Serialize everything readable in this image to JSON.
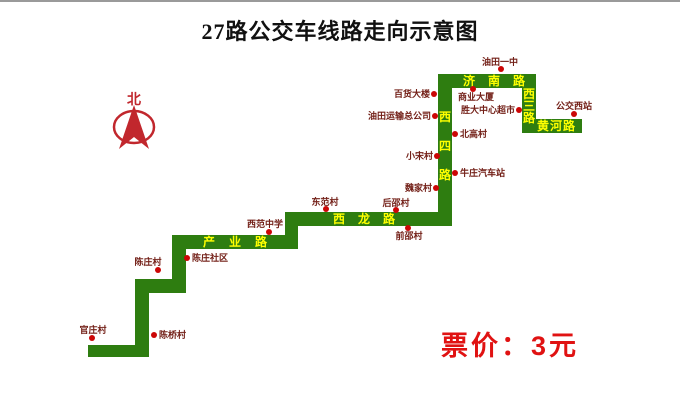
{
  "title": "27路公交车线路走向示意图",
  "compass": {
    "label": "北"
  },
  "fare": {
    "text": "票价：3元"
  },
  "colors": {
    "road_green": "#2e7d10",
    "road_label_yellow": "#ffff00",
    "stop_dot_red": "#cc0606",
    "stop_label_maroon": "#732018",
    "fare_red": "#e01212",
    "compass_red": "#c1272d",
    "title_black": "#111111"
  },
  "route": {
    "segments": [
      {
        "name": "bottom-west-segment",
        "x": 88,
        "y": 343,
        "w": 61,
        "h": 12
      },
      {
        "name": "vertical-1",
        "x": 135,
        "y": 287,
        "w": 14,
        "h": 68
      },
      {
        "name": "step-1",
        "x": 135,
        "y": 277,
        "w": 51,
        "h": 14
      },
      {
        "name": "vertical-2",
        "x": 172,
        "y": 233,
        "w": 14,
        "h": 58
      },
      {
        "name": "chanye-road",
        "x": 172,
        "y": 233,
        "w": 126,
        "h": 14
      },
      {
        "name": "vertical-3",
        "x": 285,
        "y": 210,
        "w": 13,
        "h": 37
      },
      {
        "name": "xilong-road",
        "x": 285,
        "y": 210,
        "w": 167,
        "h": 14
      },
      {
        "name": "xisi-road",
        "x": 438,
        "y": 72,
        "w": 14,
        "h": 152
      },
      {
        "name": "jinan-road",
        "x": 438,
        "y": 72,
        "w": 98,
        "h": 14
      },
      {
        "name": "xisan-road",
        "x": 522,
        "y": 72,
        "w": 14,
        "h": 59
      },
      {
        "name": "huanghe-road",
        "x": 522,
        "y": 117,
        "w": 60,
        "h": 14
      }
    ],
    "road_labels": [
      {
        "text": "产业路",
        "orient": "h",
        "x": 203,
        "y": 234,
        "spacing": 14
      },
      {
        "text": "西龙路",
        "orient": "h",
        "x": 333,
        "y": 211,
        "spacing": 13
      },
      {
        "text": "济南路",
        "orient": "h",
        "x": 463,
        "y": 73,
        "spacing": 13
      },
      {
        "text": "黄河路",
        "orient": "h",
        "x": 537,
        "y": 118,
        "spacing": 1
      },
      {
        "text": "西四路",
        "orient": "v",
        "x": 439,
        "y": 109,
        "spacing": 17
      },
      {
        "text": "西三路",
        "orient": "v",
        "x": 523,
        "y": 86,
        "spacing": 0
      }
    ],
    "stops": [
      {
        "label": "官庄村",
        "dot_x": 92,
        "dot_y": 336,
        "lx": 93,
        "ly": 328,
        "anchor": "center"
      },
      {
        "label": "陈桥村",
        "dot_x": 154,
        "dot_y": 333,
        "lx": 159,
        "ly": 333,
        "anchor": "right"
      },
      {
        "label": "陈庄村",
        "dot_x": 158,
        "dot_y": 268,
        "lx": 148,
        "ly": 260,
        "anchor": "center"
      },
      {
        "label": "陈庄社区",
        "dot_x": 187,
        "dot_y": 256,
        "lx": 192,
        "ly": 256,
        "anchor": "right"
      },
      {
        "label": "西范中学",
        "dot_x": 269,
        "dot_y": 230,
        "lx": 265,
        "ly": 222,
        "anchor": "center"
      },
      {
        "label": "东范村",
        "dot_x": 326,
        "dot_y": 207,
        "lx": 325,
        "ly": 200,
        "anchor": "center"
      },
      {
        "label": "后邵村",
        "dot_x": 396,
        "dot_y": 208,
        "lx": 396,
        "ly": 201,
        "anchor": "center"
      },
      {
        "label": "前邵村",
        "dot_x": 408,
        "dot_y": 226,
        "lx": 409,
        "ly": 234,
        "anchor": "center"
      },
      {
        "label": "魏家村",
        "dot_x": 436,
        "dot_y": 186,
        "lx": 432,
        "ly": 186,
        "anchor": "left"
      },
      {
        "label": "小宋村",
        "dot_x": 437,
        "dot_y": 154,
        "lx": 433,
        "ly": 154,
        "anchor": "left"
      },
      {
        "label": "牛庄汽车站",
        "dot_x": 455,
        "dot_y": 171,
        "lx": 460,
        "ly": 171,
        "anchor": "right"
      },
      {
        "label": "北高村",
        "dot_x": 455,
        "dot_y": 132,
        "lx": 460,
        "ly": 132,
        "anchor": "right"
      },
      {
        "label": "油田运输总公司",
        "dot_x": 435,
        "dot_y": 114,
        "lx": 431,
        "ly": 114,
        "anchor": "left"
      },
      {
        "label": "百货大楼",
        "dot_x": 434,
        "dot_y": 92,
        "lx": 430,
        "ly": 92,
        "anchor": "left"
      },
      {
        "label": "商业大厦",
        "dot_x": 473,
        "dot_y": 87,
        "lx": 476,
        "ly": 95,
        "anchor": "center"
      },
      {
        "label": "胜大中心超市",
        "dot_x": 519,
        "dot_y": 108,
        "lx": 515,
        "ly": 108,
        "anchor": "left"
      },
      {
        "label": "油田一中",
        "dot_x": 501,
        "dot_y": 67,
        "lx": 500,
        "ly": 60,
        "anchor": "center"
      },
      {
        "label": "公交西站",
        "dot_x": 574,
        "dot_y": 112,
        "lx": 574,
        "ly": 104,
        "anchor": "center"
      }
    ]
  }
}
